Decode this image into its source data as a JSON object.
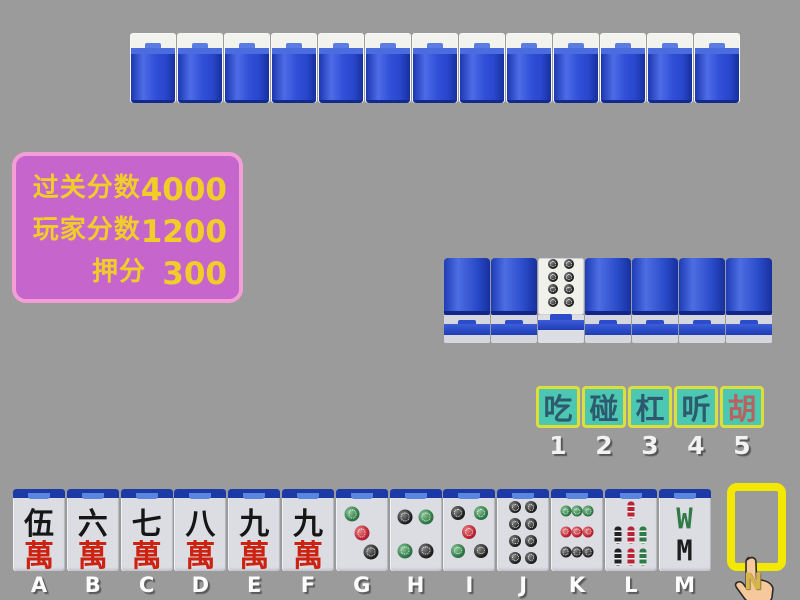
{
  "window": {
    "background": "#9b9b9b"
  },
  "opponent_row": {
    "tile_count": 13,
    "tile_back_color": "#2e4ed6"
  },
  "score_panel": {
    "bg": "#c666cd",
    "border_color": "#f39ed6",
    "text_color": "#f0cd28",
    "rows": [
      {
        "label": "过关分数",
        "value": "4000"
      },
      {
        "label": "玩家分数",
        "value": "1200"
      },
      {
        "label": "押分",
        "value": "300"
      }
    ]
  },
  "meld_row": {
    "tiles": [
      "back",
      "back",
      "face",
      "back",
      "back",
      "back",
      "back"
    ],
    "face_tile": {
      "name": "8-circles",
      "dots": [
        {
          "x": 33,
          "y": 11,
          "c": "black",
          "s": 10
        },
        {
          "x": 67,
          "y": 11,
          "c": "black",
          "s": 10
        },
        {
          "x": 33,
          "y": 33,
          "c": "black",
          "s": 10
        },
        {
          "x": 67,
          "y": 33,
          "c": "black",
          "s": 10
        },
        {
          "x": 33,
          "y": 55,
          "c": "black",
          "s": 10
        },
        {
          "x": 67,
          "y": 55,
          "c": "black",
          "s": 10
        },
        {
          "x": 33,
          "y": 77,
          "c": "black",
          "s": 10
        },
        {
          "x": 67,
          "y": 77,
          "c": "black",
          "s": 10
        }
      ]
    }
  },
  "action_panel": {
    "bg": "#4cc8b2",
    "border_color": "#dede3a",
    "buttons": [
      {
        "name": "chi",
        "label": "吃",
        "number": "1",
        "text_color": "#2d5a6e"
      },
      {
        "name": "peng",
        "label": "碰",
        "number": "2",
        "text_color": "#2d5a6e"
      },
      {
        "name": "gang",
        "label": "杠",
        "number": "3",
        "text_color": "#2d5a6e"
      },
      {
        "name": "ting",
        "label": "听",
        "number": "4",
        "text_color": "#2d5a6e"
      },
      {
        "name": "hu",
        "label": "胡",
        "number": "5",
        "text_color": "#b96060"
      }
    ]
  },
  "hand": {
    "tiles": [
      {
        "label": "A",
        "kind": "wan",
        "name": "5-wan",
        "top": "伍",
        "bottom": "萬"
      },
      {
        "label": "B",
        "kind": "wan",
        "name": "6-wan",
        "top": "六",
        "bottom": "萬"
      },
      {
        "label": "C",
        "kind": "wan",
        "name": "7-wan",
        "top": "七",
        "bottom": "萬"
      },
      {
        "label": "D",
        "kind": "wan",
        "name": "8-wan",
        "top": "八",
        "bottom": "萬"
      },
      {
        "label": "E",
        "kind": "wan",
        "name": "9-wan",
        "top": "九",
        "bottom": "萬"
      },
      {
        "label": "F",
        "kind": "wan",
        "name": "9-wan",
        "top": "九",
        "bottom": "萬"
      },
      {
        "label": "G",
        "kind": "dots",
        "name": "3-circles",
        "dots": [
          {
            "x": 32,
            "y": 22,
            "c": "green",
            "s": 15
          },
          {
            "x": 50,
            "y": 48,
            "c": "red",
            "s": 15
          },
          {
            "x": 68,
            "y": 74,
            "c": "black",
            "s": 15
          }
        ]
      },
      {
        "label": "H",
        "kind": "dots",
        "name": "4-circles",
        "dots": [
          {
            "x": 30,
            "y": 26,
            "c": "black",
            "s": 15
          },
          {
            "x": 70,
            "y": 26,
            "c": "green",
            "s": 15
          },
          {
            "x": 30,
            "y": 72,
            "c": "green",
            "s": 15
          },
          {
            "x": 70,
            "y": 72,
            "c": "black",
            "s": 15
          }
        ]
      },
      {
        "label": "I",
        "kind": "dots",
        "name": "5-circles",
        "dots": [
          {
            "x": 28,
            "y": 21,
            "c": "black",
            "s": 14
          },
          {
            "x": 72,
            "y": 21,
            "c": "green",
            "s": 14
          },
          {
            "x": 50,
            "y": 46,
            "c": "red",
            "s": 14
          },
          {
            "x": 28,
            "y": 72,
            "c": "green",
            "s": 14
          },
          {
            "x": 72,
            "y": 72,
            "c": "black",
            "s": 14
          }
        ]
      },
      {
        "label": "J",
        "kind": "dots",
        "name": "8-circles",
        "dots": [
          {
            "x": 35,
            "y": 13,
            "c": "black",
            "s": 12
          },
          {
            "x": 65,
            "y": 13,
            "c": "black",
            "s": 12
          },
          {
            "x": 35,
            "y": 36,
            "c": "black",
            "s": 12
          },
          {
            "x": 65,
            "y": 36,
            "c": "black",
            "s": 12
          },
          {
            "x": 35,
            "y": 59,
            "c": "black",
            "s": 12
          },
          {
            "x": 65,
            "y": 59,
            "c": "black",
            "s": 12
          },
          {
            "x": 35,
            "y": 82,
            "c": "black",
            "s": 12
          },
          {
            "x": 65,
            "y": 82,
            "c": "black",
            "s": 12
          }
        ]
      },
      {
        "label": "K",
        "kind": "dots",
        "name": "9-circles",
        "dots": [
          {
            "x": 28,
            "y": 18,
            "c": "green",
            "s": 11
          },
          {
            "x": 50,
            "y": 18,
            "c": "green",
            "s": 11
          },
          {
            "x": 72,
            "y": 18,
            "c": "green",
            "s": 11
          },
          {
            "x": 28,
            "y": 46,
            "c": "red",
            "s": 11
          },
          {
            "x": 50,
            "y": 46,
            "c": "red",
            "s": 11
          },
          {
            "x": 72,
            "y": 46,
            "c": "red",
            "s": 11
          },
          {
            "x": 28,
            "y": 74,
            "c": "black",
            "s": 11
          },
          {
            "x": 50,
            "y": 74,
            "c": "black",
            "s": 11
          },
          {
            "x": 72,
            "y": 74,
            "c": "black",
            "s": 11
          }
        ]
      },
      {
        "label": "L",
        "kind": "bamboo",
        "name": "7-bamboo",
        "sticks": [
          {
            "x": 50,
            "y": 17,
            "c": "sred"
          },
          {
            "x": 26,
            "y": 50,
            "c": "sblack"
          },
          {
            "x": 50,
            "y": 50,
            "c": "sred"
          },
          {
            "x": 74,
            "y": 50,
            "c": "sgreen"
          },
          {
            "x": 26,
            "y": 81,
            "c": "sblack"
          },
          {
            "x": 50,
            "y": 81,
            "c": "sred"
          },
          {
            "x": 74,
            "y": 81,
            "c": "sgreen"
          }
        ]
      },
      {
        "label": "M",
        "kind": "bamboo8",
        "name": "8-bamboo",
        "top": "W",
        "bottom": "M"
      }
    ],
    "next_slot_label": "N"
  },
  "cursor": {
    "name": "pointing-hand"
  }
}
